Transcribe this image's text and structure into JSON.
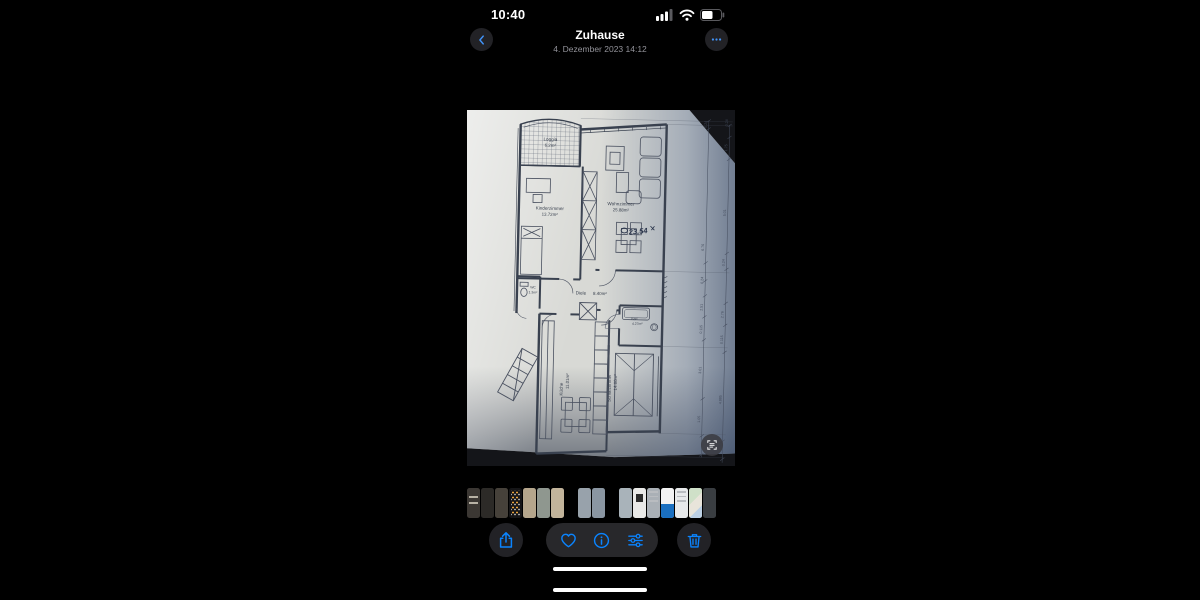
{
  "status_bar": {
    "time": "10:40",
    "icons": [
      "cellular-signal",
      "wifi",
      "battery"
    ],
    "battery_level": 0.55
  },
  "nav": {
    "title": "Zuhause",
    "subtitle": "4. Dezember 2023 14:12"
  },
  "photo": {
    "kind": "scanned floor plan",
    "rooms": {
      "loggia": {
        "label": "Loggia",
        "area": "6.2m²"
      },
      "kinder": {
        "label": "Kinderzimmer",
        "area": "13.72m²"
      },
      "wohn": {
        "label": "Wohnzimmer",
        "area": "25.88m²"
      },
      "wc": {
        "label": "WC",
        "area": "1.3m²"
      },
      "diele": {
        "label": "Diele",
        "area": "8.40m²"
      },
      "bad": {
        "label": "Bad",
        "area": "4.27m²"
      },
      "schlaf": {
        "label": "Schlafzimmer",
        "area": "14.60m²"
      },
      "kueche": {
        "label": "Küche",
        "area": "11.01m²"
      }
    },
    "annotation": "23,54",
    "dims_a": [
      {
        "v": "0.24",
        "y": 12
      },
      {
        "v": "6.76",
        "y": 135
      },
      {
        "v": "0.24",
        "y": 168
      },
      {
        "v": "2.51",
        "y": 195
      },
      {
        "v": "0.115",
        "y": 217
      },
      {
        "v": "3.01",
        "y": 258
      },
      {
        "v": "1.05",
        "y": 307
      }
    ],
    "dims_b": [
      {
        "v": "0.24",
        "y": 10
      },
      {
        "v": "1.75",
        "y": 35
      },
      {
        "v": "5.01",
        "y": 100
      },
      {
        "v": "0.24",
        "y": 150
      },
      {
        "v": "2.76",
        "y": 202
      },
      {
        "v": "0.115",
        "y": 227
      },
      {
        "v": "4.885",
        "y": 287
      }
    ]
  },
  "thumbnails": {
    "items": [
      {
        "kind": "bars",
        "color": "#3b3733"
      },
      {
        "kind": "photo",
        "color": "#2c2a27"
      },
      {
        "kind": "photo",
        "color": "#46413a"
      },
      {
        "kind": "grid",
        "color": "#151517"
      },
      {
        "kind": "photo",
        "color": "#b5a68c"
      },
      {
        "kind": "photo",
        "color": "#8f978f"
      },
      {
        "kind": "photo",
        "color": "#c2b49b"
      },
      {
        "kind": "gap"
      },
      {
        "kind": "photo",
        "color": "#98a2ab"
      },
      {
        "kind": "photo",
        "color": "#8a96a2"
      },
      {
        "kind": "gap"
      },
      {
        "kind": "photo",
        "color": "#a9b3ba"
      },
      {
        "kind": "qr",
        "color": "#e9e9e7"
      },
      {
        "kind": "lines",
        "color": "#aab0b6"
      },
      {
        "kind": "split",
        "color": "#f2f2f2",
        "accent": "#1a6fc0"
      },
      {
        "kind": "lines",
        "color": "#e7e9ea"
      },
      {
        "kind": "map",
        "color": "#e3e6e0"
      },
      {
        "kind": "photo",
        "color": "#393d41"
      }
    ]
  },
  "toolbar": {
    "accent": "#0a84ff",
    "icons": [
      "share",
      "favorite",
      "info",
      "adjust",
      "delete"
    ]
  }
}
